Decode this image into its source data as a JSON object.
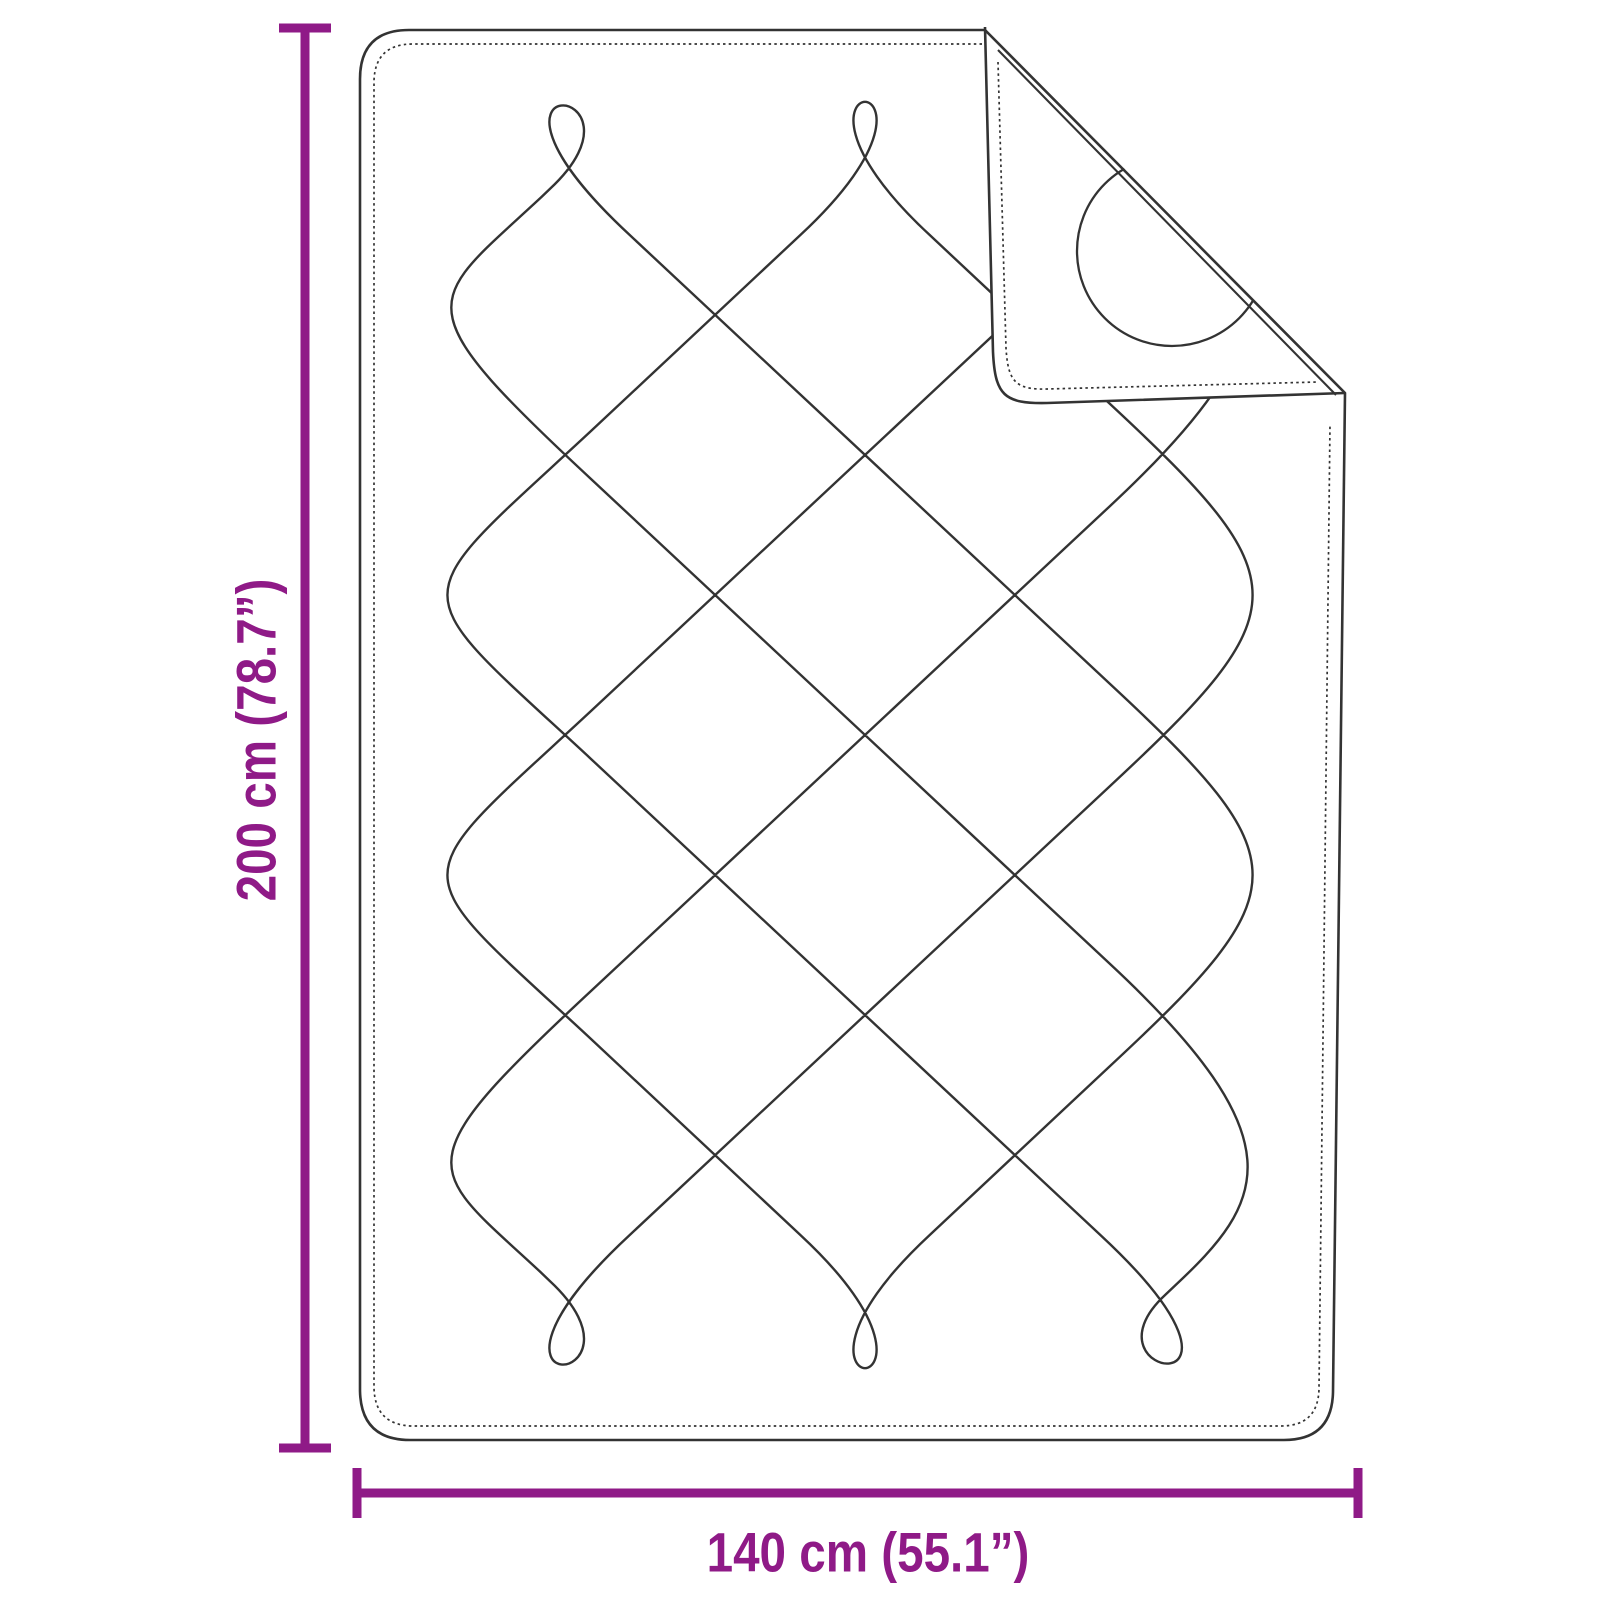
{
  "figure": {
    "kind": "product dimension diagram",
    "subject": "quilted blanket with folded corner"
  },
  "colors": {
    "accent": "#8f1a87",
    "ink": "#333333",
    "background": "#ffffff"
  },
  "height_dimension": {
    "label": "200 cm (78.7”)",
    "value_cm": 200,
    "value_inches": 78.7
  },
  "width_dimension": {
    "label": "140 cm (55.1”)",
    "value_cm": 140,
    "value_inches": 55.1
  }
}
